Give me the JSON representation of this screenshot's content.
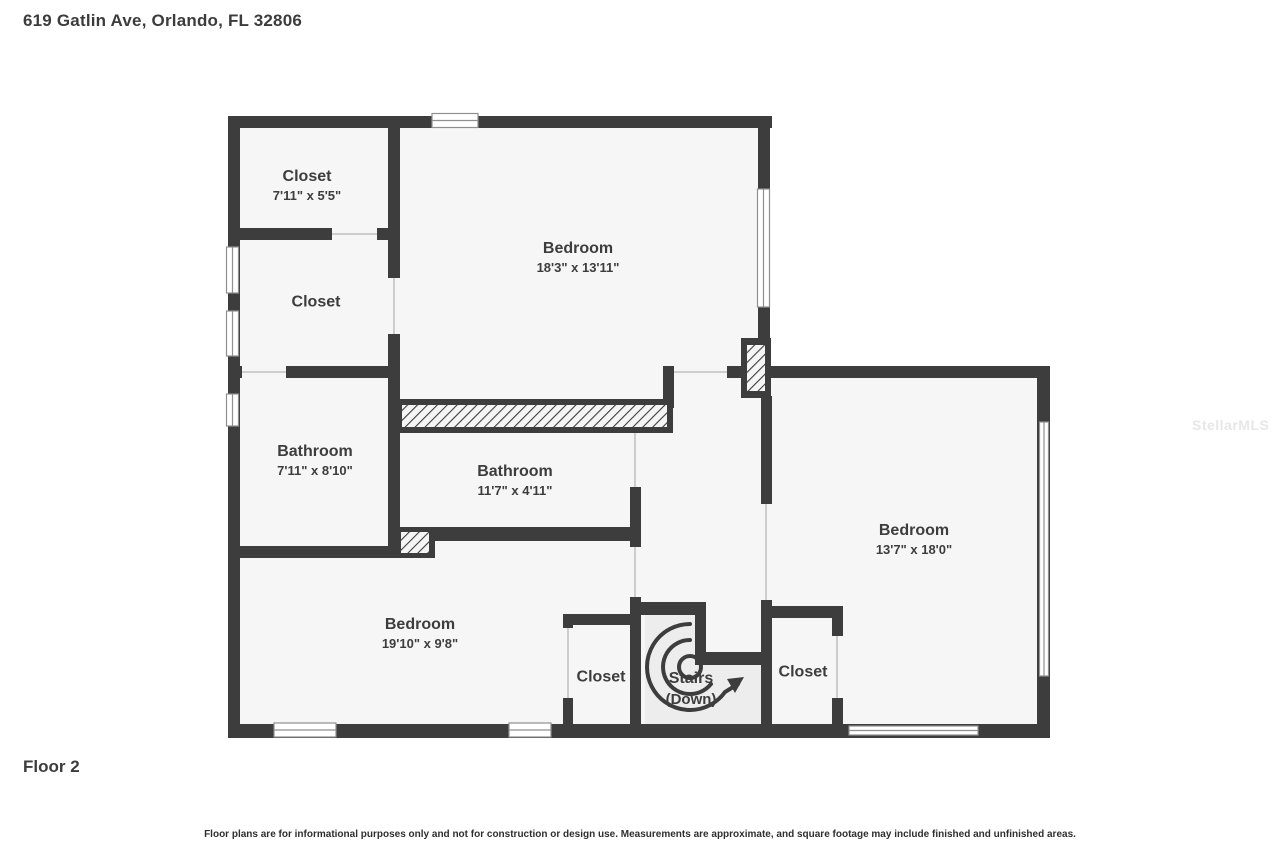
{
  "title": "619 Gatlin Ave, Orlando, FL 32806",
  "floor_label": "Floor 2",
  "disclaimer": "Floor plans are for informational purposes only and not for construction or design use. Measurements are approximate, and square footage may include finished and unfinished areas.",
  "watermark": "StellarMLS",
  "colors": {
    "wall": "#3d3d3d",
    "room_fill": "#f6f6f6",
    "stairs_fill": "#ededed",
    "door_line": "#cdcdcd",
    "window_frame": "#909090",
    "text": "#3d3d3d",
    "watermark": "#e7e7e7"
  },
  "rooms": [
    {
      "id": "closet-top-left",
      "name": "Closet",
      "dims": "7'11\" x 5'5\""
    },
    {
      "id": "bedroom-top",
      "name": "Bedroom",
      "dims": "18'3\" x 13'11\""
    },
    {
      "id": "closet-mid-left",
      "name": "Closet",
      "dims": ""
    },
    {
      "id": "bathroom-left",
      "name": "Bathroom",
      "dims": "7'11\" x 8'10\""
    },
    {
      "id": "bathroom-center",
      "name": "Bathroom",
      "dims": "11'7\" x 4'11\""
    },
    {
      "id": "bedroom-right",
      "name": "Bedroom",
      "dims": "13'7\" x 18'0\""
    },
    {
      "id": "bedroom-bottom",
      "name": "Bedroom",
      "dims": "19'10\" x 9'8\""
    },
    {
      "id": "closet-bottom",
      "name": "Closet",
      "dims": ""
    },
    {
      "id": "stairs",
      "name": "Stairs",
      "dims": "(Down)"
    },
    {
      "id": "closet-bottom-right",
      "name": "Closet",
      "dims": ""
    }
  ]
}
